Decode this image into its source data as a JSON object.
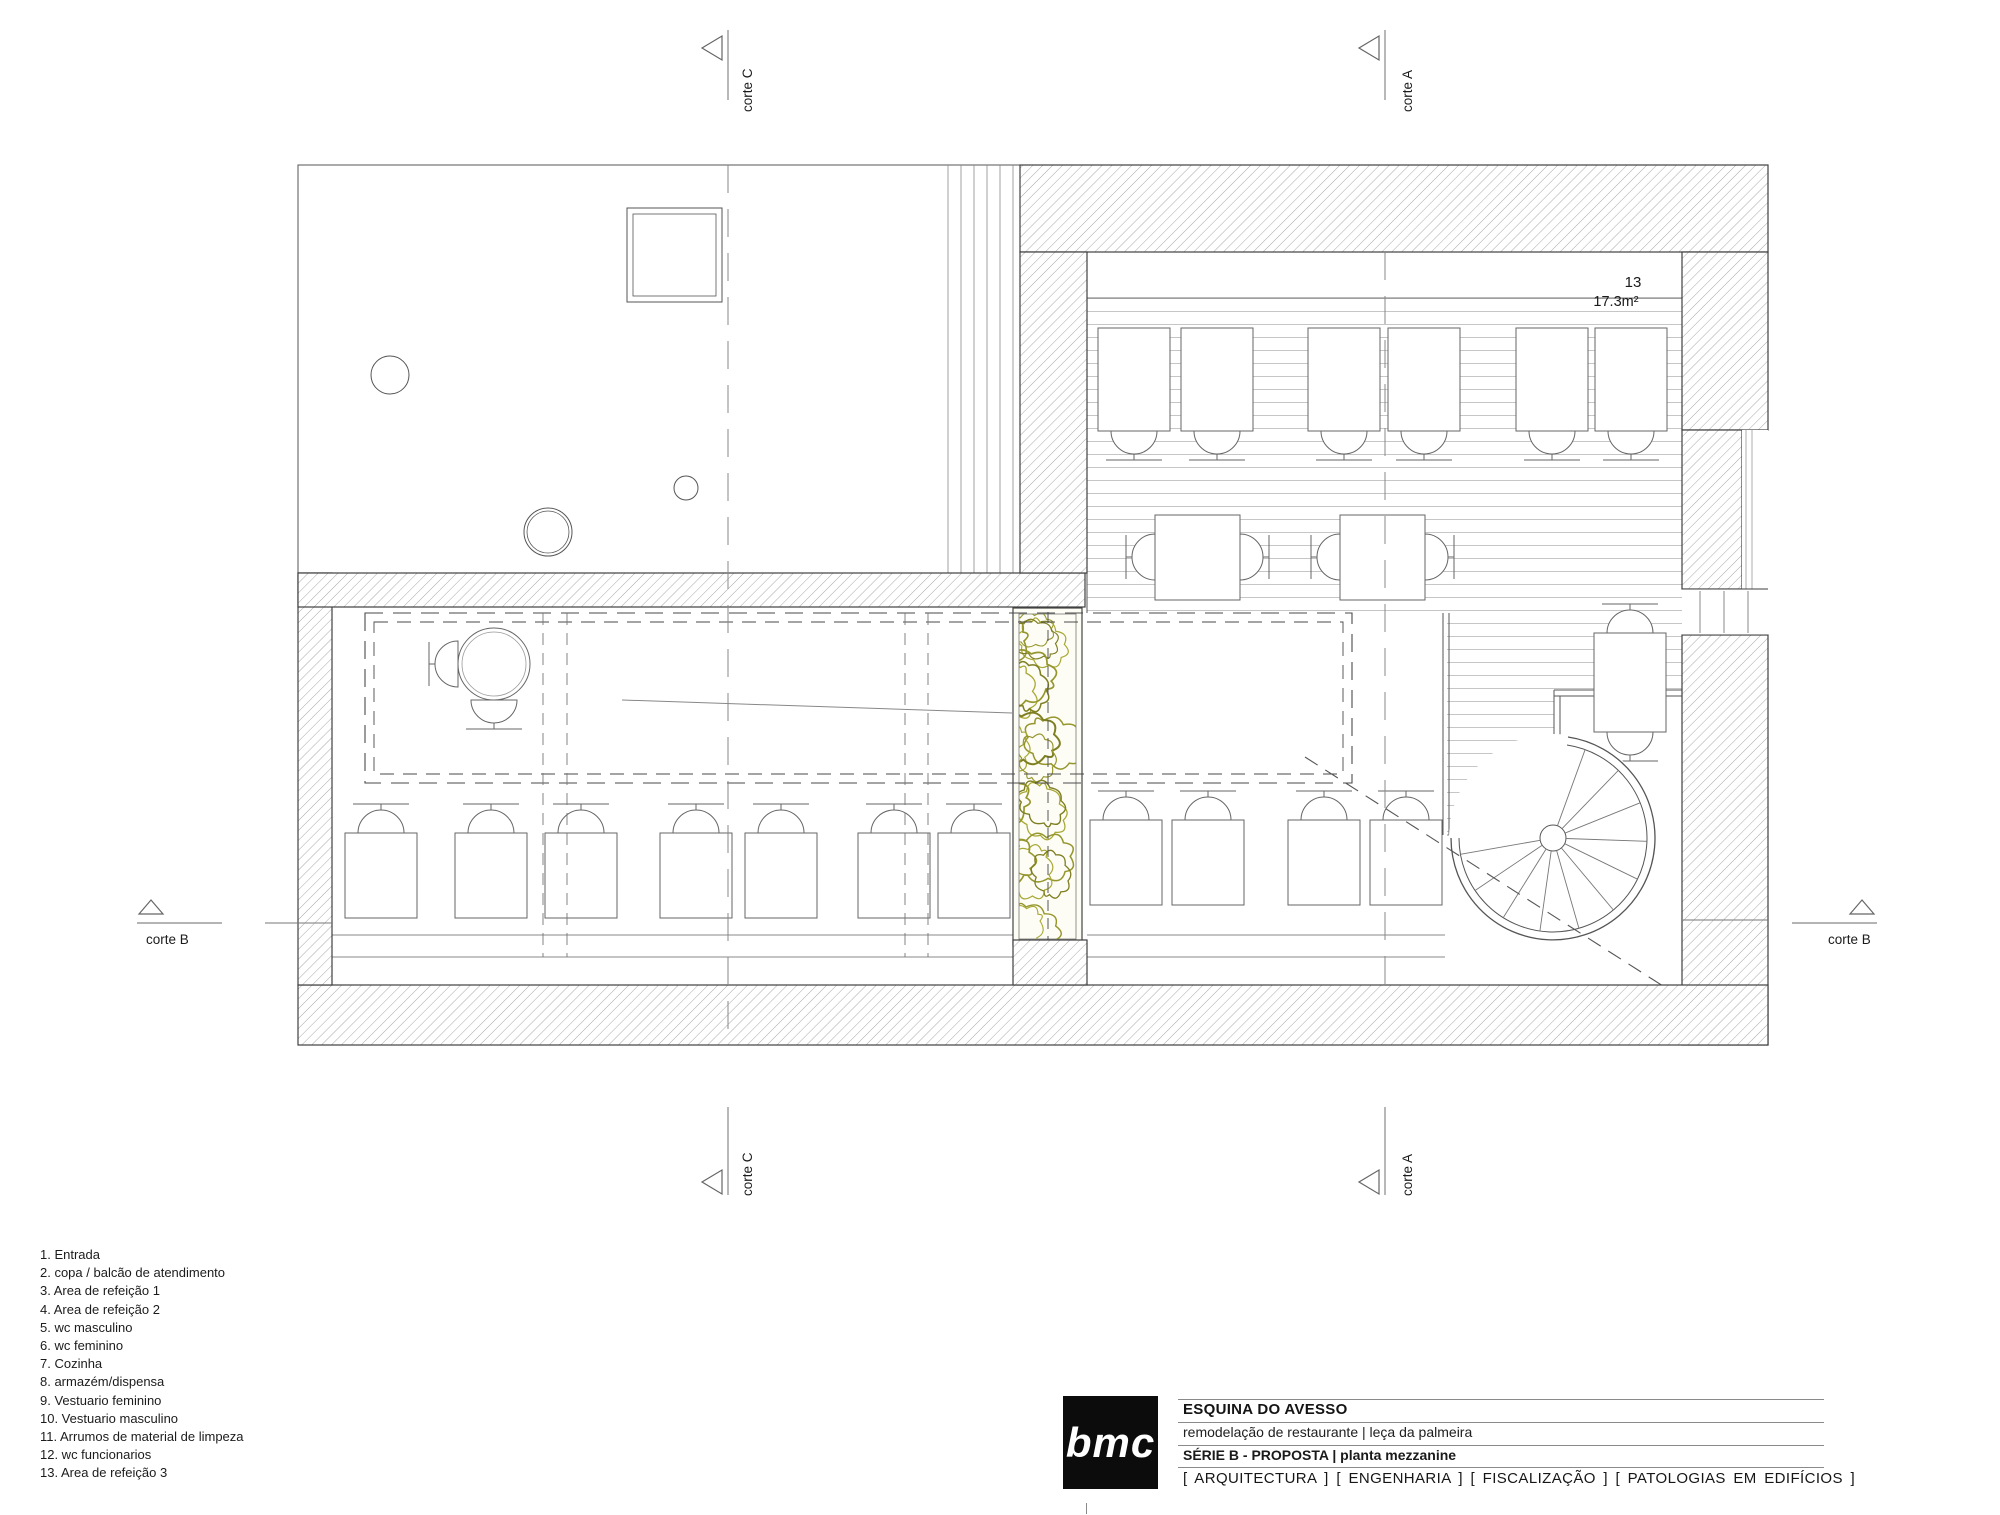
{
  "drawing_labels": {
    "corte_a": "corte A",
    "corte_b": "corte B",
    "corte_c": "corte C",
    "room13_number": "13",
    "room13_area": "17.3m²"
  },
  "legend": {
    "items": [
      "1. Entrada",
      "2. copa / balcão de atendimento",
      "3. Area de refeição 1",
      "4. Area de refeição 2",
      "5. wc masculino",
      "6. wc feminino",
      "7. Cozinha",
      "8. armazém/dispensa",
      "9. Vestuario feminino",
      "10. Vestuario masculino",
      "11. Arrumos de material de limpeza",
      "12. wc funcionarios",
      "13. Area de refeição 3"
    ]
  },
  "title_block": {
    "logo": "bmc",
    "project_name": "ESQUINA DO AVESSO",
    "project_description": "remodelação de restaurante | leça da palmeira",
    "phase": "SÉRIE B - PROPOSTA | planta mezzanine",
    "disciplines": "[ ARQUITECTURA ] [ ENGENHARIA ] [ FISCALIZAÇÃO ] [ PATOLOGIAS EM EDIFÍCIOS ]"
  },
  "colors": {
    "wall_hatch": "#a8a8a8",
    "line_dark": "#3f3f3f",
    "planter_green": "#96962e",
    "deck_plank": "#c6c6c6"
  }
}
